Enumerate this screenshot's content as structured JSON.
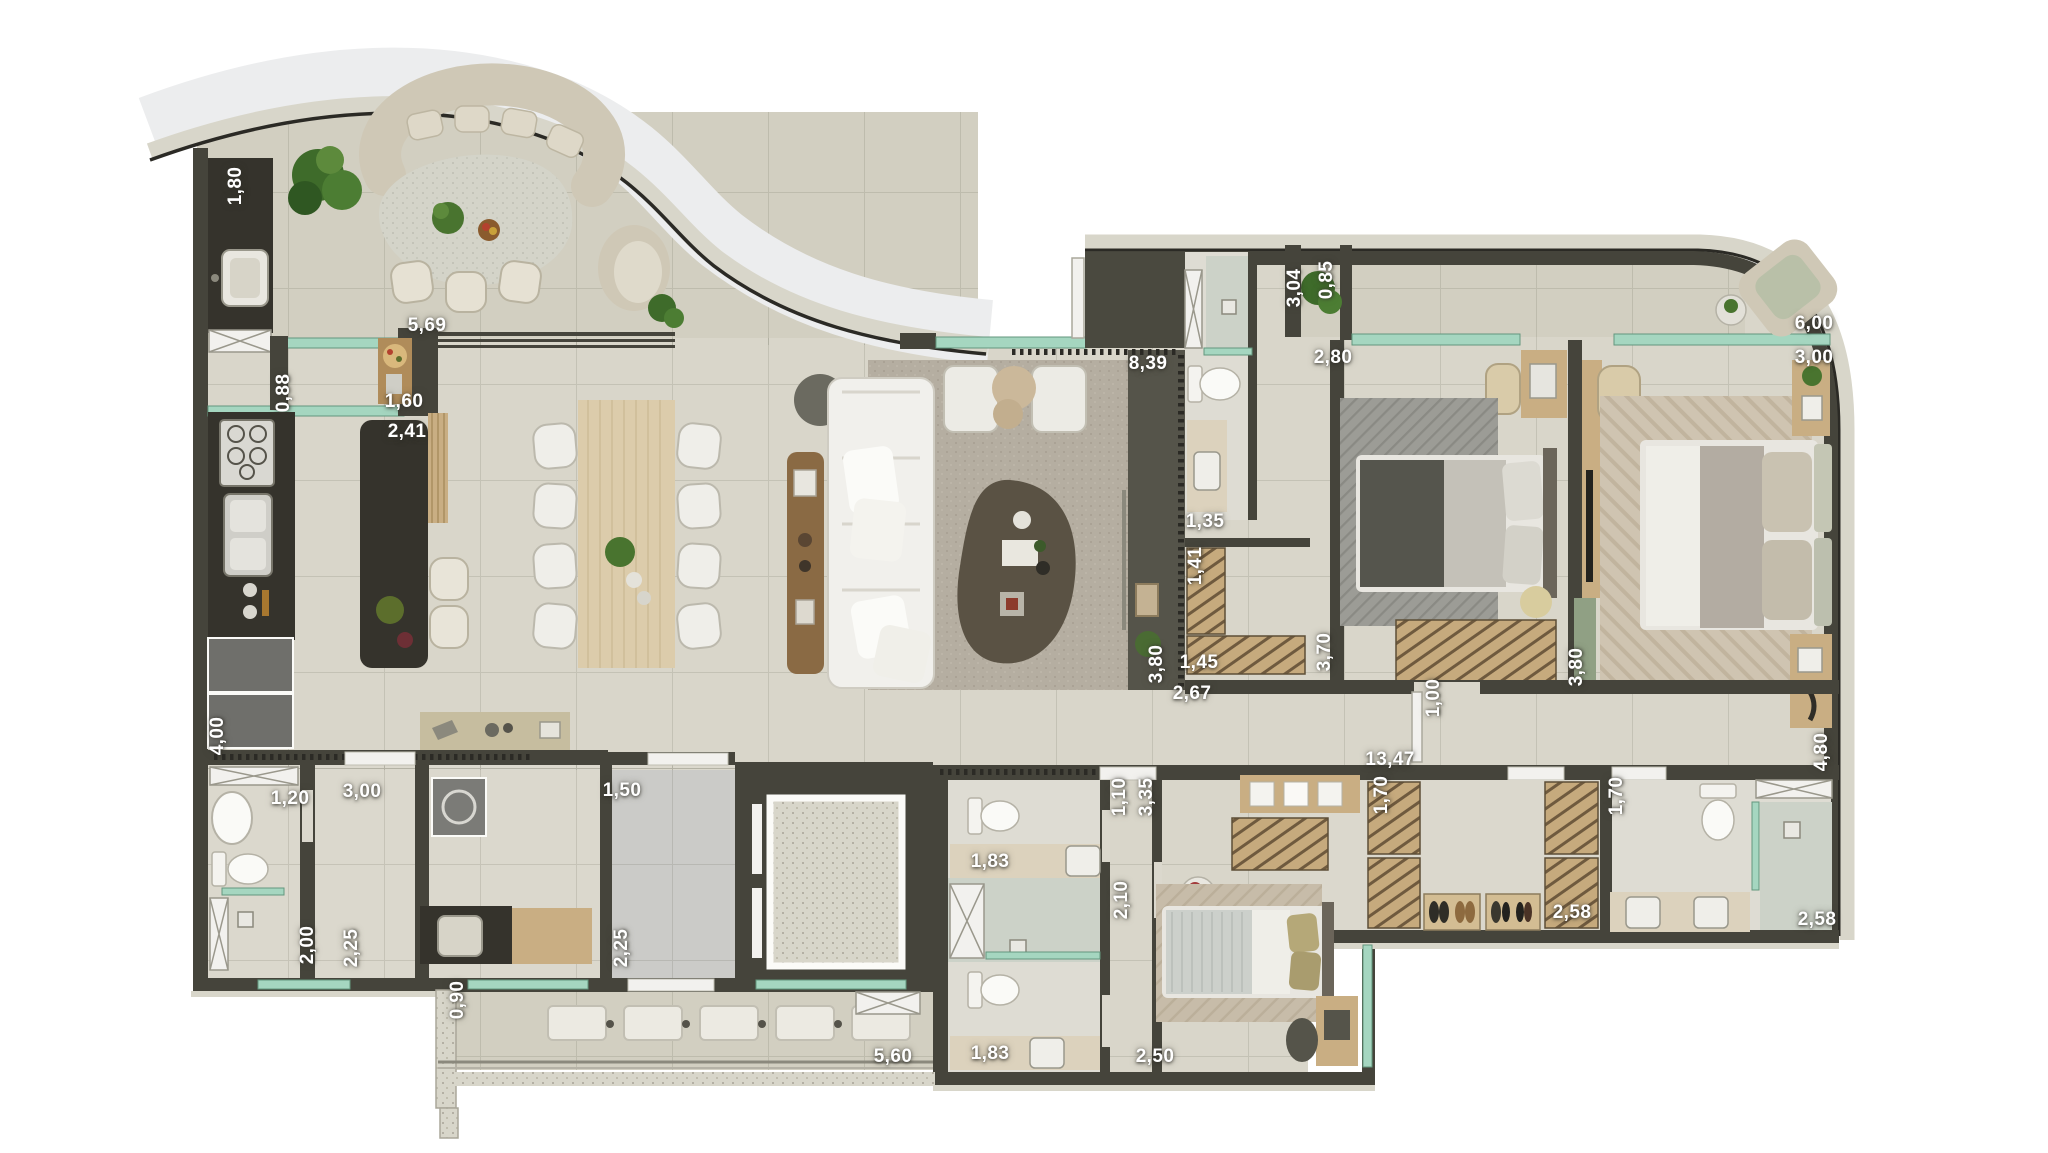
{
  "plan": {
    "type": "apartment-floor-plan-top-view",
    "colors": {
      "background": "#ffffff",
      "wall": "#45443b",
      "wall_dark": "#34332c",
      "floor": "#d9d6ca",
      "floor_balcony": "#d2cfc1",
      "floor_common": "#cbcbc8",
      "stone_band": "#d8d6ca",
      "wood": "#c9ae83",
      "wood_light": "#dcccab",
      "counter_dark": "#35332c",
      "upholstery_white": "#f1f0ec",
      "upholstery_beige": "#cfc8b6",
      "rug": "#b5aea1",
      "glass_green": "#a5d6c0",
      "plant_green": "#49742f",
      "label_text": "#ffffff"
    },
    "dimension_labels": [
      {
        "value": "1,80",
        "x": 236,
        "y": 186,
        "rot": -90
      },
      {
        "value": "5,69",
        "x": 427,
        "y": 326,
        "rot": 0
      },
      {
        "value": "0,88",
        "x": 284,
        "y": 393,
        "rot": -90
      },
      {
        "value": "1,60",
        "x": 404,
        "y": 402,
        "rot": 0
      },
      {
        "value": "2,41",
        "x": 407,
        "y": 432,
        "rot": 0
      },
      {
        "value": "8,39",
        "x": 1148,
        "y": 364,
        "rot": 0
      },
      {
        "value": "3,04",
        "x": 1295,
        "y": 288,
        "rot": -90
      },
      {
        "value": "0,85",
        "x": 1327,
        "y": 280,
        "rot": -90
      },
      {
        "value": "2,80",
        "x": 1333,
        "y": 358,
        "rot": 0
      },
      {
        "value": "6,00",
        "x": 1814,
        "y": 324,
        "rot": 0
      },
      {
        "value": "3,00",
        "x": 1814,
        "y": 358,
        "rot": 0
      },
      {
        "value": "1,35",
        "x": 1205,
        "y": 522,
        "rot": 0
      },
      {
        "value": "1,41",
        "x": 1196,
        "y": 566,
        "rot": -90
      },
      {
        "value": "3,80",
        "x": 1157,
        "y": 664,
        "rot": -90
      },
      {
        "value": "1,45",
        "x": 1199,
        "y": 663,
        "rot": 0
      },
      {
        "value": "3,70",
        "x": 1325,
        "y": 652,
        "rot": -90
      },
      {
        "value": "2,67",
        "x": 1192,
        "y": 694,
        "rot": 0
      },
      {
        "value": "1,00",
        "x": 1434,
        "y": 698,
        "rot": -90
      },
      {
        "value": "3,80",
        "x": 1577,
        "y": 667,
        "rot": -90
      },
      {
        "value": "13,47",
        "x": 1390,
        "y": 760,
        "rot": 0
      },
      {
        "value": "4,80",
        "x": 1822,
        "y": 752,
        "rot": -90
      },
      {
        "value": "1,70",
        "x": 1382,
        "y": 795,
        "rot": -90
      },
      {
        "value": "1,70",
        "x": 1617,
        "y": 796,
        "rot": -90
      },
      {
        "value": "2,58",
        "x": 1572,
        "y": 913,
        "rot": 0
      },
      {
        "value": "2,58",
        "x": 1817,
        "y": 920,
        "rot": 0
      },
      {
        "value": "4,00",
        "x": 218,
        "y": 736,
        "rot": -90
      },
      {
        "value": "3,00",
        "x": 362,
        "y": 792,
        "rot": 0
      },
      {
        "value": "1,20",
        "x": 290,
        "y": 799,
        "rot": 0
      },
      {
        "value": "2,00",
        "x": 308,
        "y": 945,
        "rot": -90
      },
      {
        "value": "2,25",
        "x": 352,
        "y": 948,
        "rot": -90
      },
      {
        "value": "1,50",
        "x": 622,
        "y": 791,
        "rot": 0
      },
      {
        "value": "2,25",
        "x": 622,
        "y": 948,
        "rot": -90
      },
      {
        "value": "0,90",
        "x": 458,
        "y": 1000,
        "rot": -90
      },
      {
        "value": "5,60",
        "x": 893,
        "y": 1057,
        "rot": 0
      },
      {
        "value": "1,83",
        "x": 990,
        "y": 862,
        "rot": 0
      },
      {
        "value": "2,10",
        "x": 1122,
        "y": 900,
        "rot": -90
      },
      {
        "value": "1,83",
        "x": 990,
        "y": 1054,
        "rot": 0
      },
      {
        "value": "2,50",
        "x": 1155,
        "y": 1057,
        "rot": 0
      },
      {
        "value": "1,10",
        "x": 1120,
        "y": 797,
        "rot": -90
      },
      {
        "value": "3,35",
        "x": 1147,
        "y": 797,
        "rot": -90
      }
    ]
  }
}
